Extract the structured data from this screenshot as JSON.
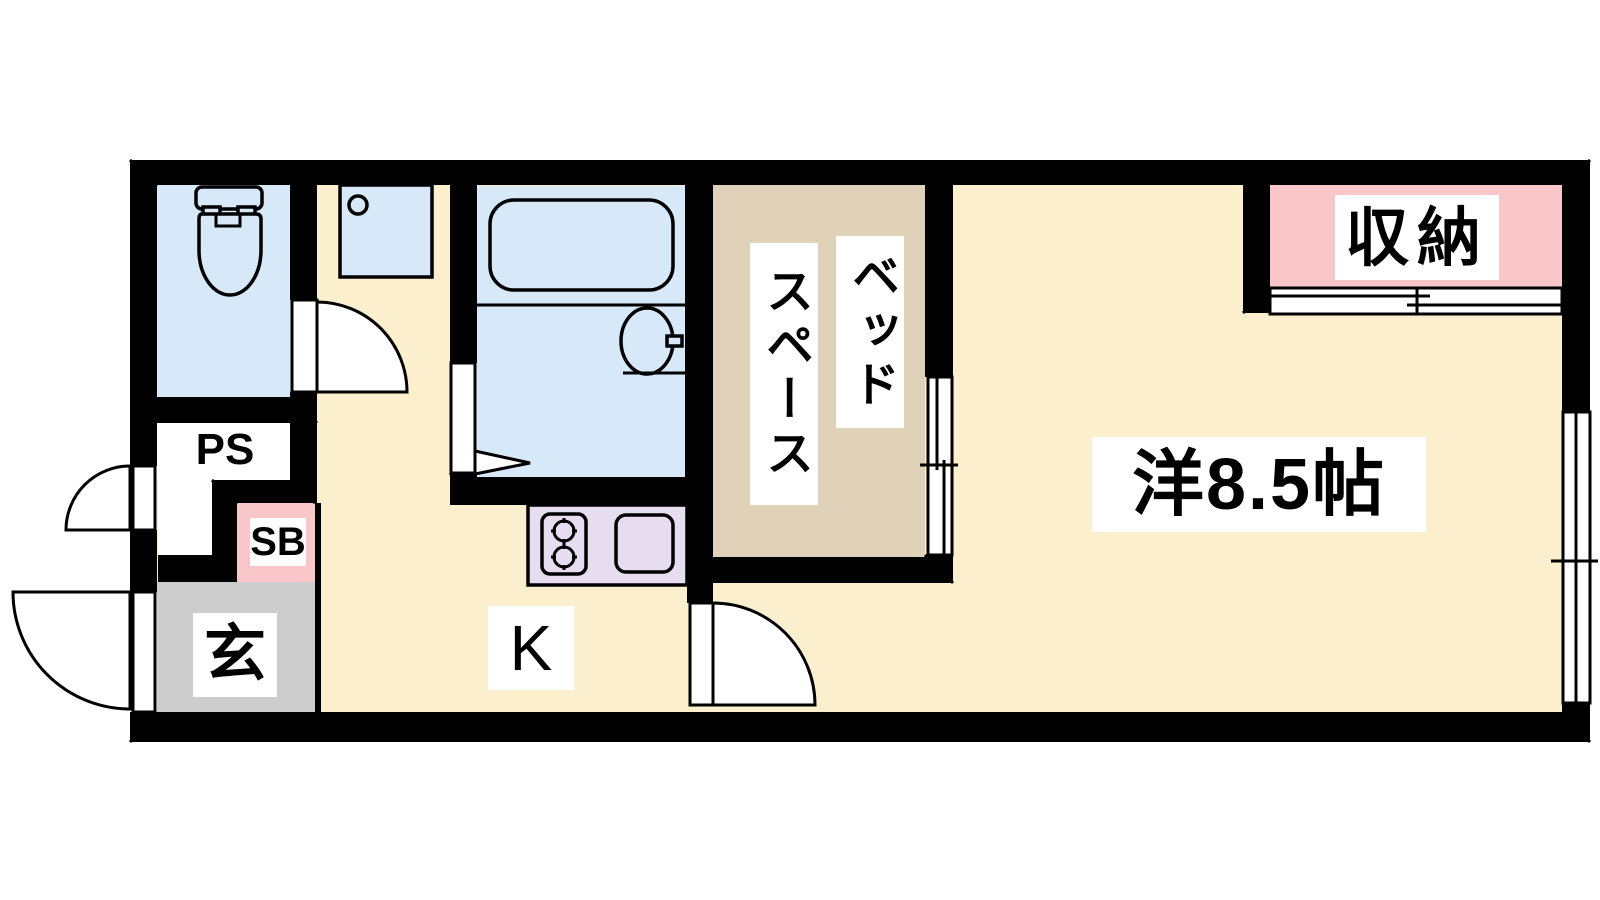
{
  "plan_title": "1K apartment floor plan",
  "labels": {
    "pipe_space": "PS",
    "shoe_box": "SB",
    "entrance": "玄",
    "kitchen": "K",
    "bed_space_col1": "ベッド",
    "bed_space_col2": "スペース",
    "storage": "収納",
    "western_room": "洋8.5帖"
  },
  "rooms": [
    {
      "id": "toilet",
      "label": "",
      "fill": "water_blue"
    },
    {
      "id": "washroom-alcove",
      "label": "",
      "fill": "floor_cream"
    },
    {
      "id": "bathroom",
      "label": "",
      "fill": "water_blue"
    },
    {
      "id": "bed-space",
      "label": "ベッドスペース",
      "fill": "bed_space_tan"
    },
    {
      "id": "western-room",
      "label": "洋8.5帖",
      "fill": "floor_cream"
    },
    {
      "id": "storage",
      "label": "収納",
      "fill": "storage_pink"
    },
    {
      "id": "kitchen",
      "label": "K",
      "fill": "floor_cream"
    },
    {
      "id": "entrance",
      "label": "玄",
      "fill": "entrance_gray"
    },
    {
      "id": "pipe-space",
      "label": "PS",
      "fill": "label_bg"
    },
    {
      "id": "shoe-box",
      "label": "SB",
      "fill": "storage_pink"
    }
  ],
  "colors": {
    "wall": "#000000",
    "floor_cream": "#FBEFCE",
    "water_blue": "#D7E8F9",
    "bed_space_tan": "#E0D2B8",
    "storage_pink": "#F9C7C9",
    "kitchen_lavender": "#E6DDF1",
    "entrance_gray": "#CDCDCD",
    "label_bg": "#FFFFFF",
    "label_text": "#000000"
  }
}
